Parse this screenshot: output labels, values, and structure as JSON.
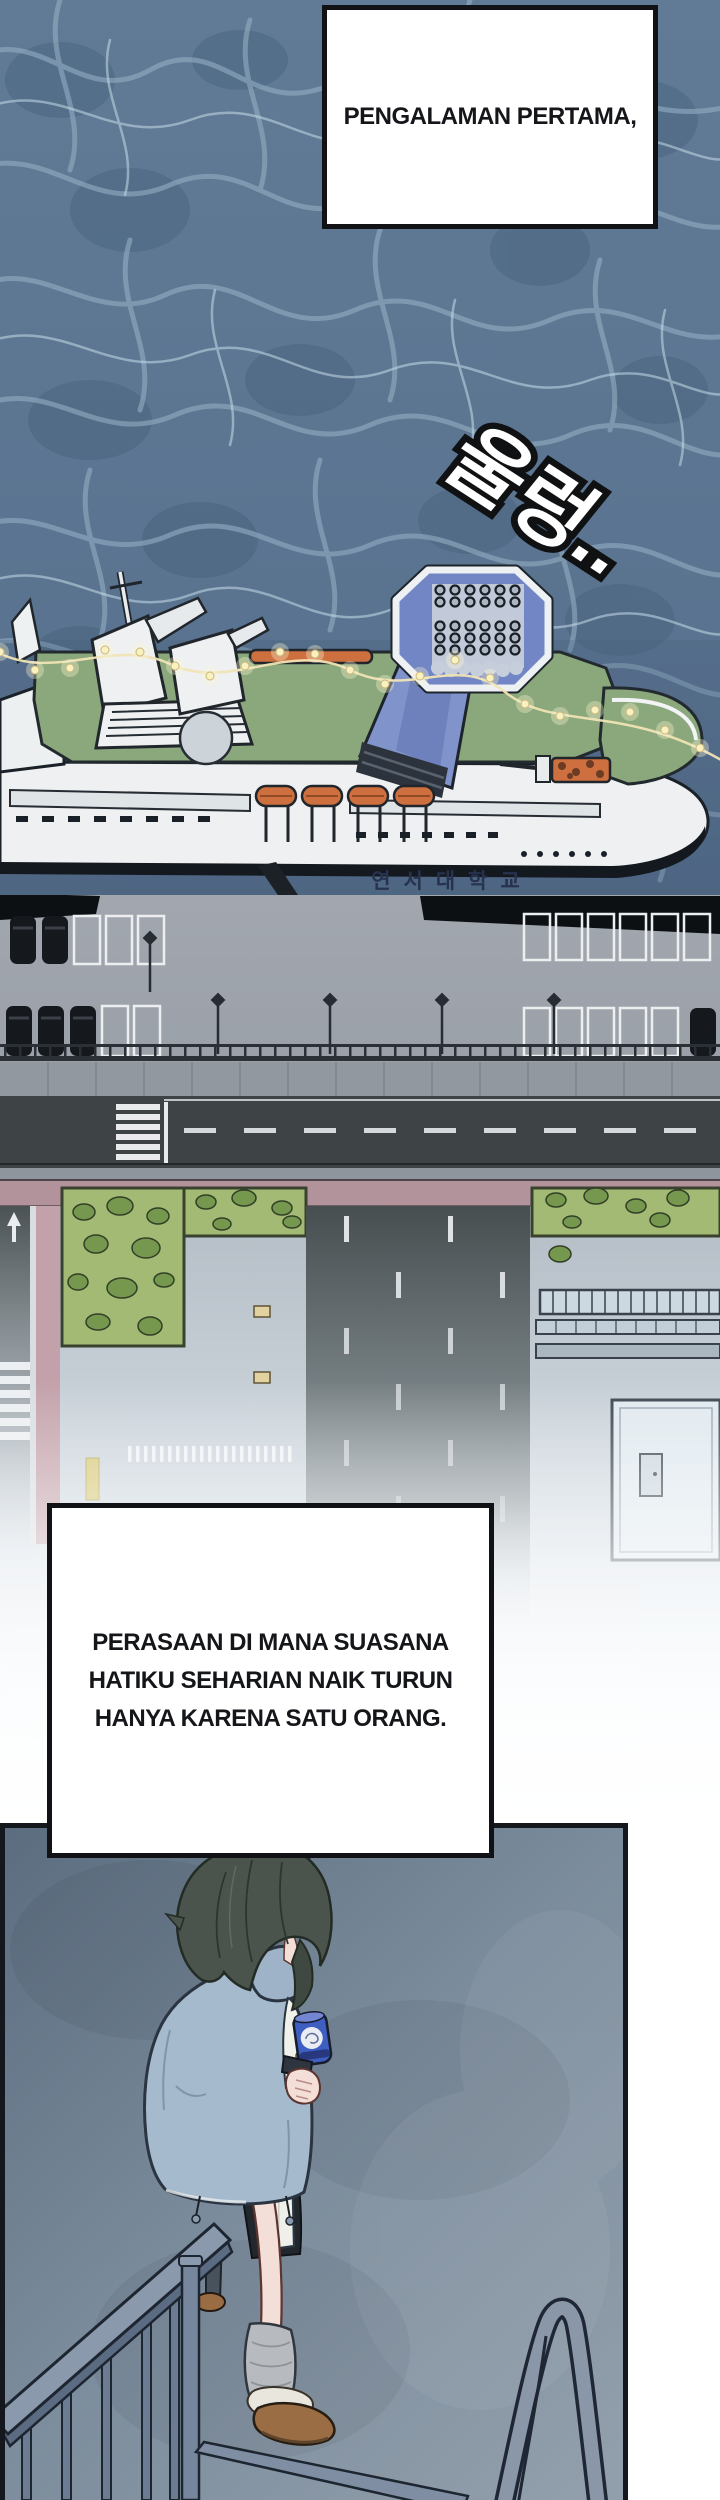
{
  "captions": {
    "top": "PENGALAMAN PERTAMA,",
    "middle_lines": [
      "PERASAAN DI MANA SUASANA",
      "HATIKU SEHARIAN NAIK TURUN",
      "HANYA KARENA SATU ORANG."
    ]
  },
  "sfx": {
    "korean": "울렁.."
  },
  "ship": {
    "hull_text": "연서대학교"
  },
  "palette": {
    "water_base": "#5c7591",
    "water_vein_light": "#9cb6c9",
    "water_vein_bright": "#c6dce8",
    "deck_green": "#8aa87b",
    "funnel_blue": "#7285c5",
    "lifeboat_orange": "#cd6f3e",
    "hull_white": "#eef0f1",
    "pier_gray": "#9ba1a9",
    "road_dark": "#3e4446",
    "grass_green": "#a2ba73",
    "bush_green": "#75974e",
    "sidewalk_pink": "#c3a1aa",
    "panel_wall": "#6b7d8e",
    "jacket_blue": "#a6bacd",
    "hair_dark": "#4a544d",
    "skin": "#f3ded8",
    "can_blue": "#3f5ec2",
    "slipper_brown": "#9b6d45",
    "ink_black": "#101215"
  }
}
